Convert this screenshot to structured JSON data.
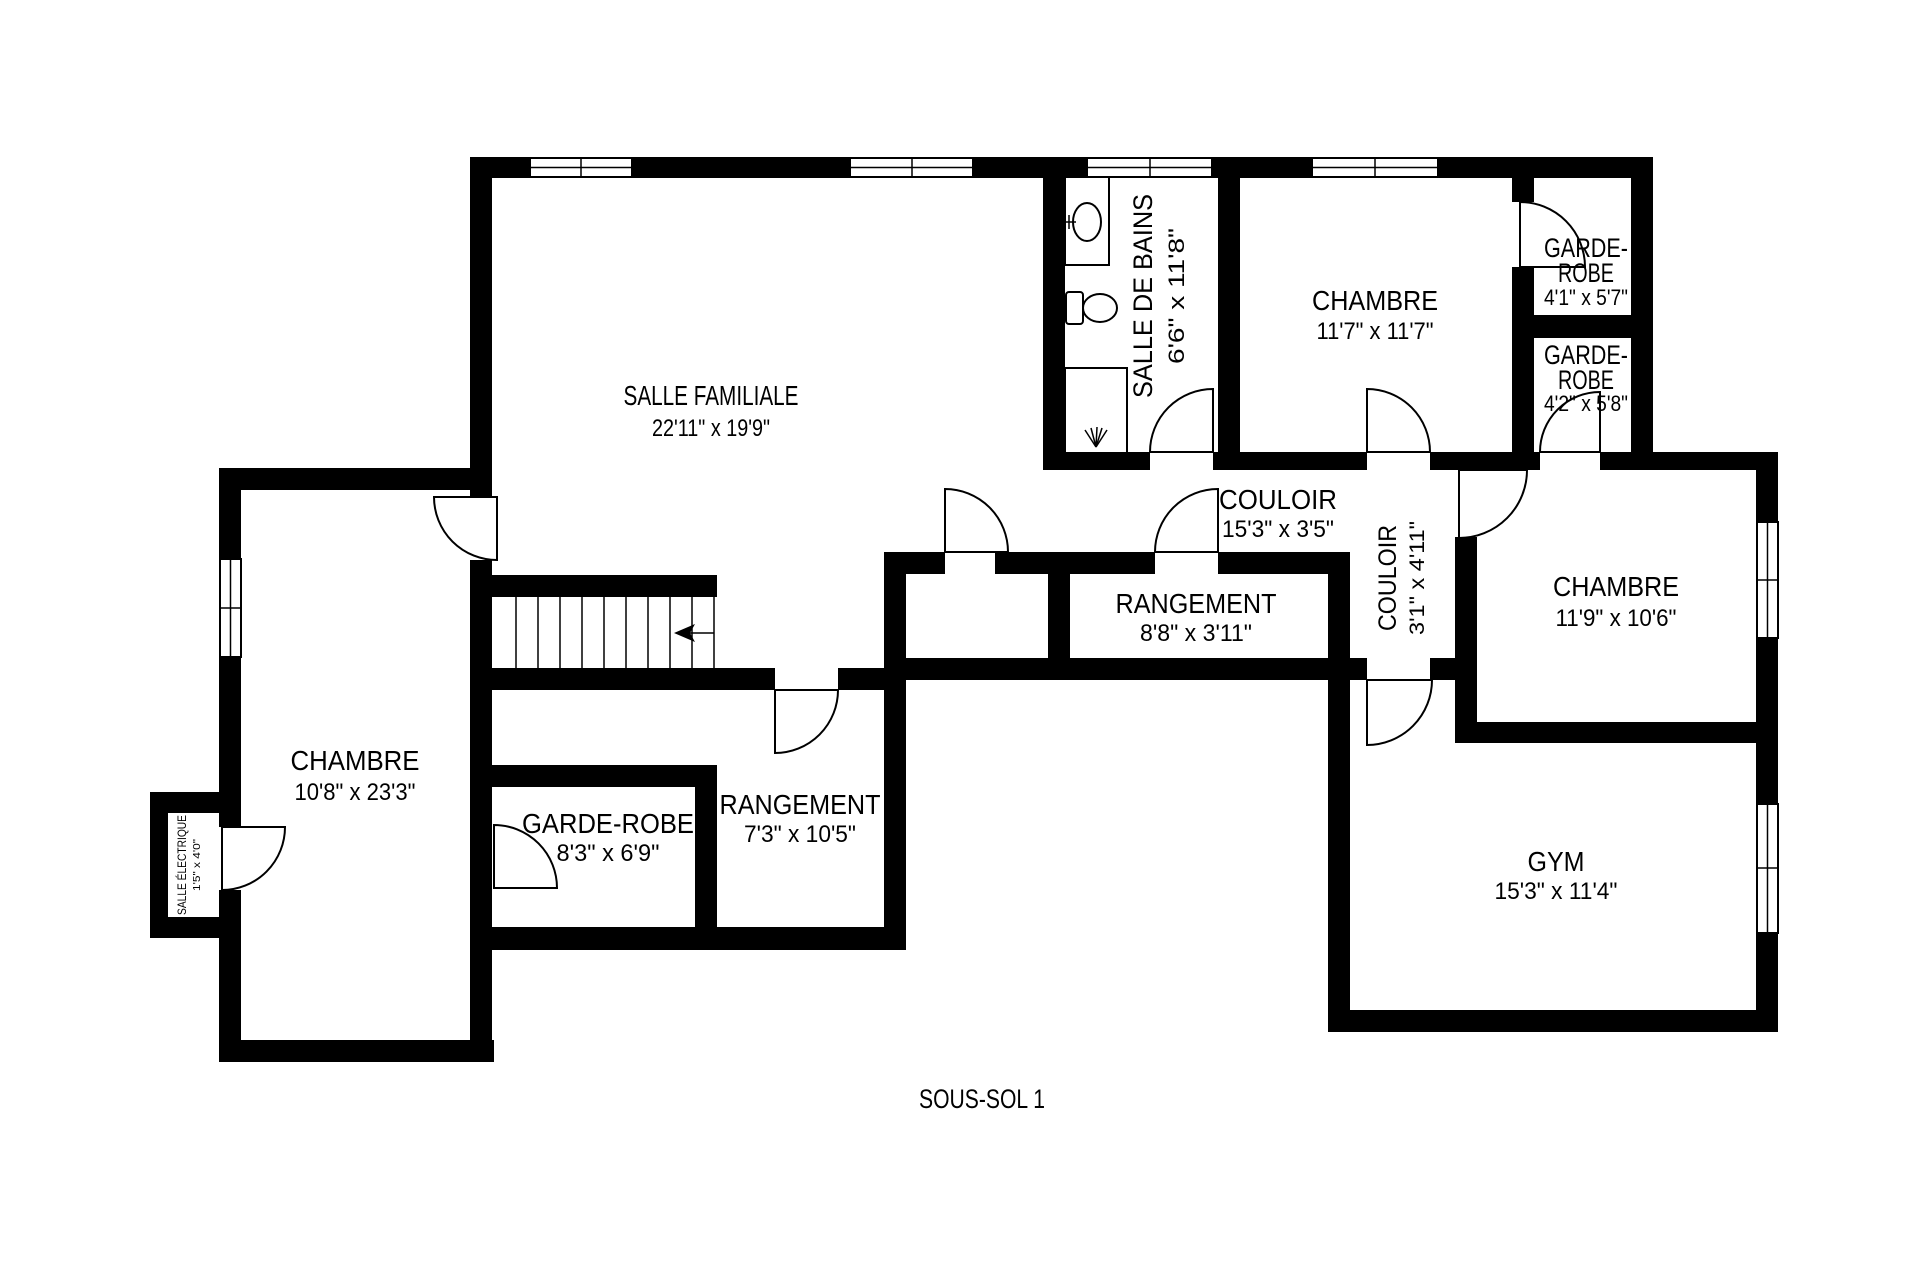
{
  "title": "SOUS-SOL 1",
  "colors": {
    "walls": "#000000",
    "background": "#ffffff",
    "text": "#000000"
  },
  "rooms": {
    "salle_familiale": {
      "name": "SALLE FAMILIALE",
      "dims": "22'11\" x 19'9\""
    },
    "salle_de_bains": {
      "name": "SALLE DE BAINS",
      "dims": "6'6\" x 11'8\""
    },
    "chambre_haut": {
      "name": "CHAMBRE",
      "dims": "11'7\" x 11'7\""
    },
    "garde_robe_1": {
      "line1": "GARDE-",
      "line2": "ROBE",
      "dims": "4'1\" x 5'7\""
    },
    "garde_robe_2": {
      "line1": "GARDE-",
      "line2": "ROBE",
      "dims": "4'2\" x 5'8\""
    },
    "couloir": {
      "name": "COULOIR",
      "dims": "15'3\" x 3'5\""
    },
    "couloir_2": {
      "name": "COULOIR",
      "dims": "3'1\" x 4'11\""
    },
    "chambre_droite": {
      "name": "CHAMBRE",
      "dims": "11'9\" x 10'6\""
    },
    "rangement": {
      "name": "RANGEMENT",
      "dims": "8'8\" x 3'11\""
    },
    "chambre_gauche": {
      "name": "CHAMBRE",
      "dims": "10'8\" x 23'3\""
    },
    "garde_robe_gauche": {
      "name": "GARDE-ROBE",
      "dims": "8'3\" x 6'9\""
    },
    "rangement_bas": {
      "name": "RANGEMENT",
      "dims": "7'3\" x 10'5\""
    },
    "gym": {
      "name": "GYM",
      "dims": "15'3\" x 11'4\""
    },
    "salle_electrique": {
      "name": "SALLE ÉLECTRIQUE",
      "dims": "1'5\" x 4'0\""
    }
  }
}
